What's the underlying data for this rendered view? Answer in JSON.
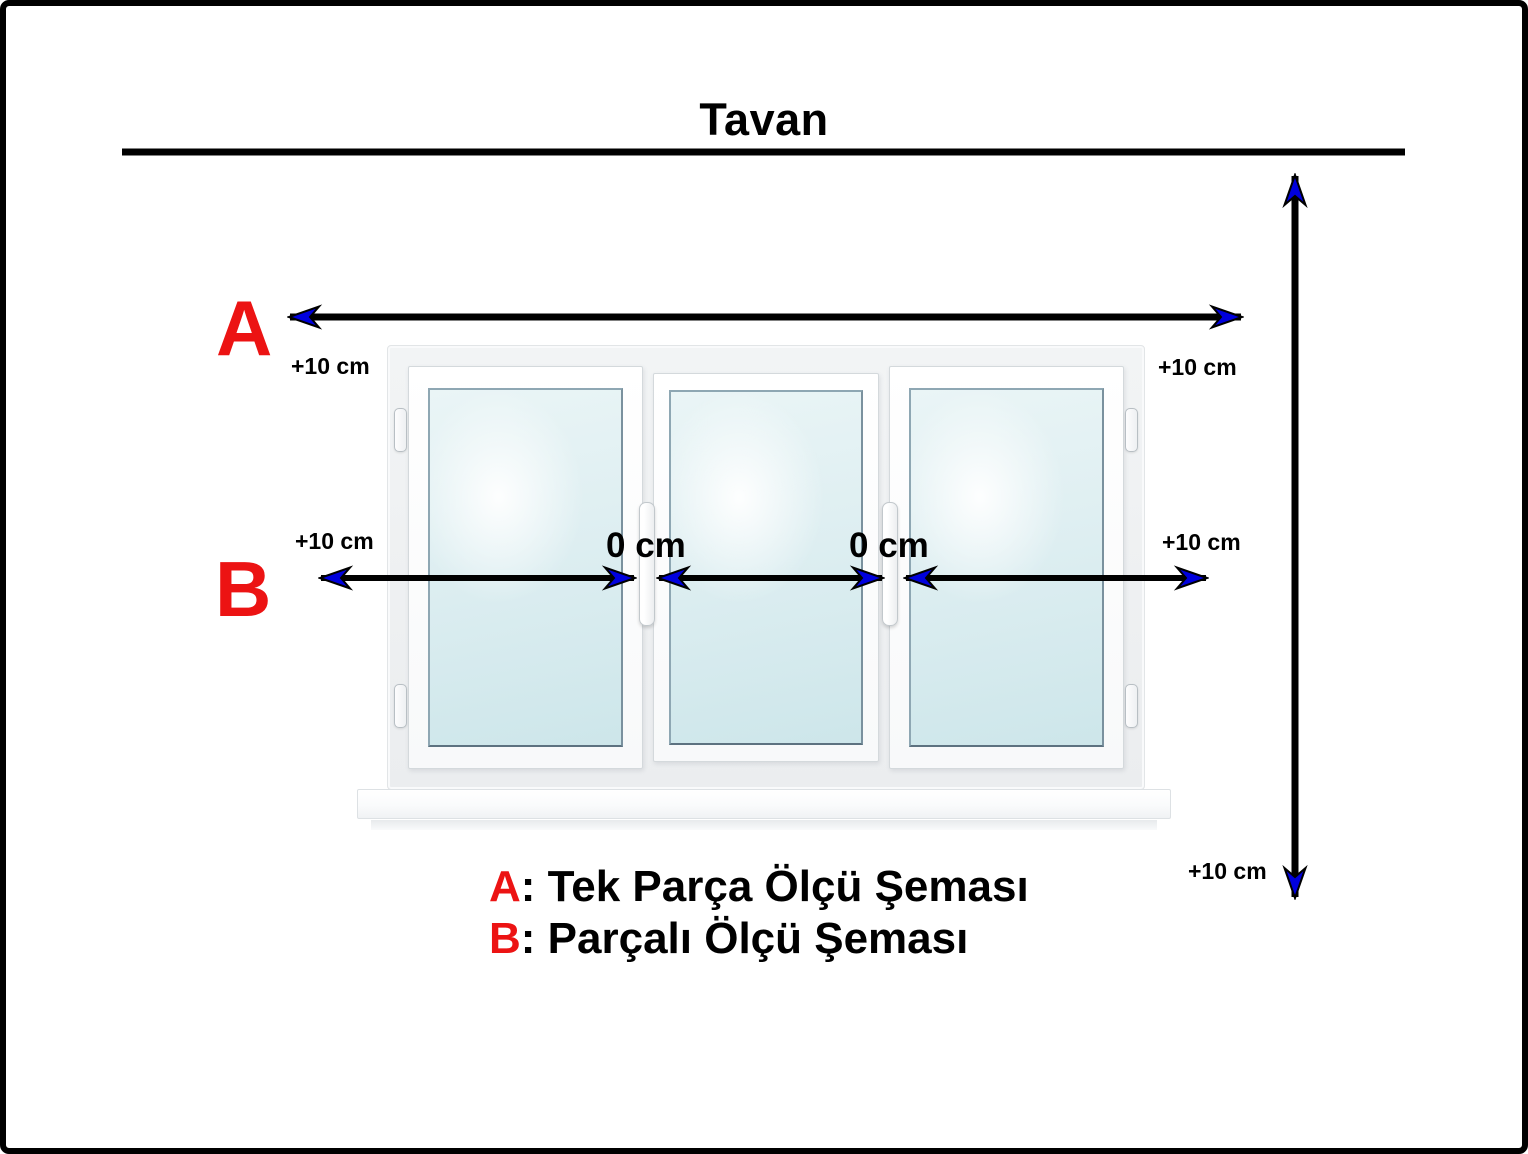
{
  "title": "Tavan",
  "colors": {
    "label_red": "#ec1313",
    "arrowhead_blue": "#0000dd",
    "line_black": "#000000"
  },
  "measure_a": {
    "label": "A",
    "left_offset": "+10 cm",
    "right_offset": "+10 cm"
  },
  "measure_b": {
    "label": "B",
    "left_offset": "+10 cm",
    "right_offset": "+10 cm",
    "joint_left": "0 cm",
    "joint_right": "0 cm"
  },
  "measure_height": {
    "bottom_offset": "+10 cm"
  },
  "legend": {
    "items": [
      {
        "key": "A",
        "text": ": Tek Parça Ölçü Şeması"
      },
      {
        "key": "B",
        "text": ": Parçalı Ölçü Şeması"
      }
    ]
  }
}
